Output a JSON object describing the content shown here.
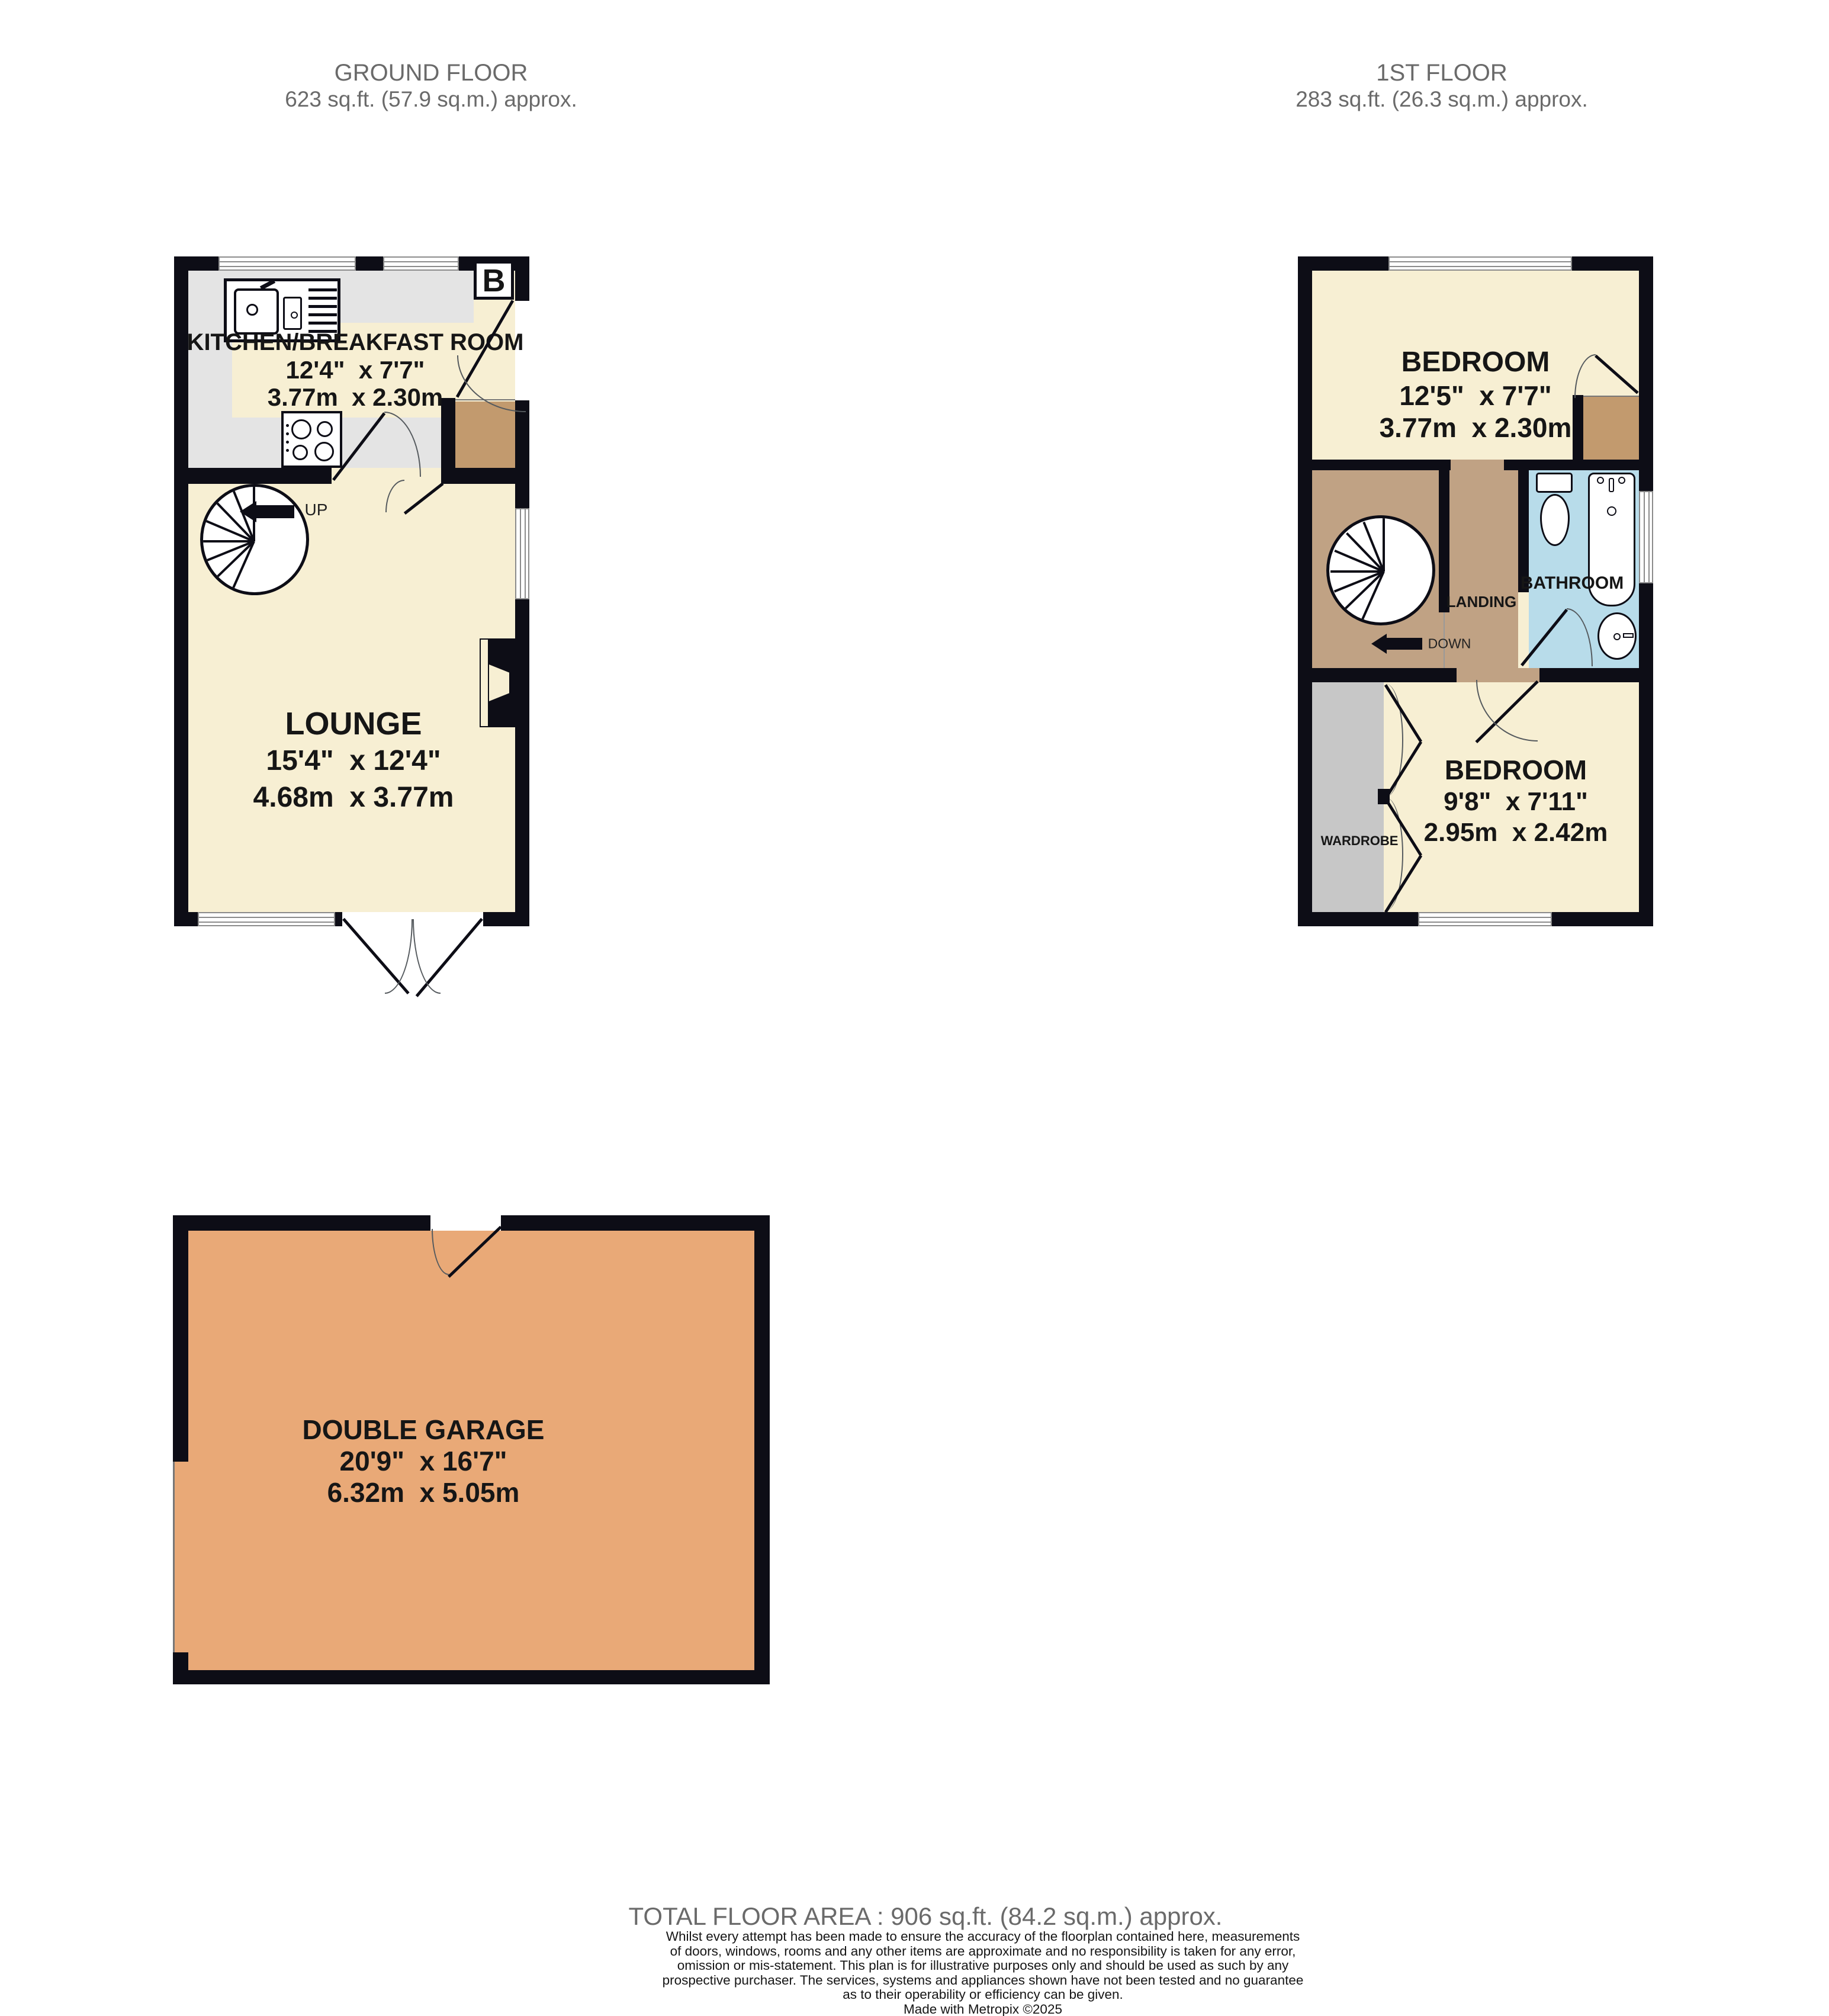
{
  "header": {
    "ground_floor_title": "GROUND FLOOR",
    "ground_floor_area": "623 sq.ft. (57.9 sq.m.) approx.",
    "first_floor_title": "1ST FLOOR",
    "first_floor_area": "283 sq.ft. (26.3 sq.m.) approx."
  },
  "ground_floor": {
    "kitchen": {
      "name": "KITCHEN/BREAKFAST ROOM",
      "imperial": "12'4\"  x 7'7\"",
      "metric": "3.77m  x 2.30m"
    },
    "lounge": {
      "name": "LOUNGE",
      "imperial": "15'4\"  x 12'4\"",
      "metric": "4.68m  x 3.77m"
    },
    "stair_label": "UP",
    "boiler_label": "B"
  },
  "first_floor": {
    "bedroom_front": {
      "name": "BEDROOM",
      "imperial": "12'5\"  x 7'7\"",
      "metric": "3.77m  x 2.30m"
    },
    "bedroom_back": {
      "name": "BEDROOM",
      "imperial": "9'8\"  x 7'11\"",
      "metric": "2.95m  x 2.42m"
    },
    "bathroom_label": "BATHROOM",
    "landing_label": "LANDING",
    "stair_label": "DOWN",
    "wardrobe_label": "WARDROBE"
  },
  "garage": {
    "name": "DOUBLE GARAGE",
    "imperial": "20'9\"  x 16'7\"",
    "metric": "6.32m  x 5.05m"
  },
  "footer": {
    "total_area": "TOTAL FLOOR AREA : 906 sq.ft. (84.2 sq.m.) approx.",
    "disclaimer_lines": [
      "Whilst every attempt has been made to ensure the accuracy of the floorplan contained here, measurements",
      "of doors, windows, rooms and any other items are approximate and no responsibility is taken for any error,",
      "omission or mis-statement. This plan is for illustrative purposes only and should be used as such by any",
      "prospective purchaser. The services, systems and appliances shown have not been tested and no guarantee",
      "as to their operability or efficiency can be given."
    ],
    "credit": "Made with Metropix ©2025"
  },
  "colors": {
    "wall": "#0d0d16",
    "room_cream": "#f7efd3",
    "kitchen_gray": "#e4e4e4",
    "landing_brown": "#c0a284",
    "threshold_brown": "#c29a6e",
    "bathroom_blue": "#b8dcea",
    "wardrobe_gray": "#c7c7c7",
    "garage_orange": "#e9a977"
  }
}
